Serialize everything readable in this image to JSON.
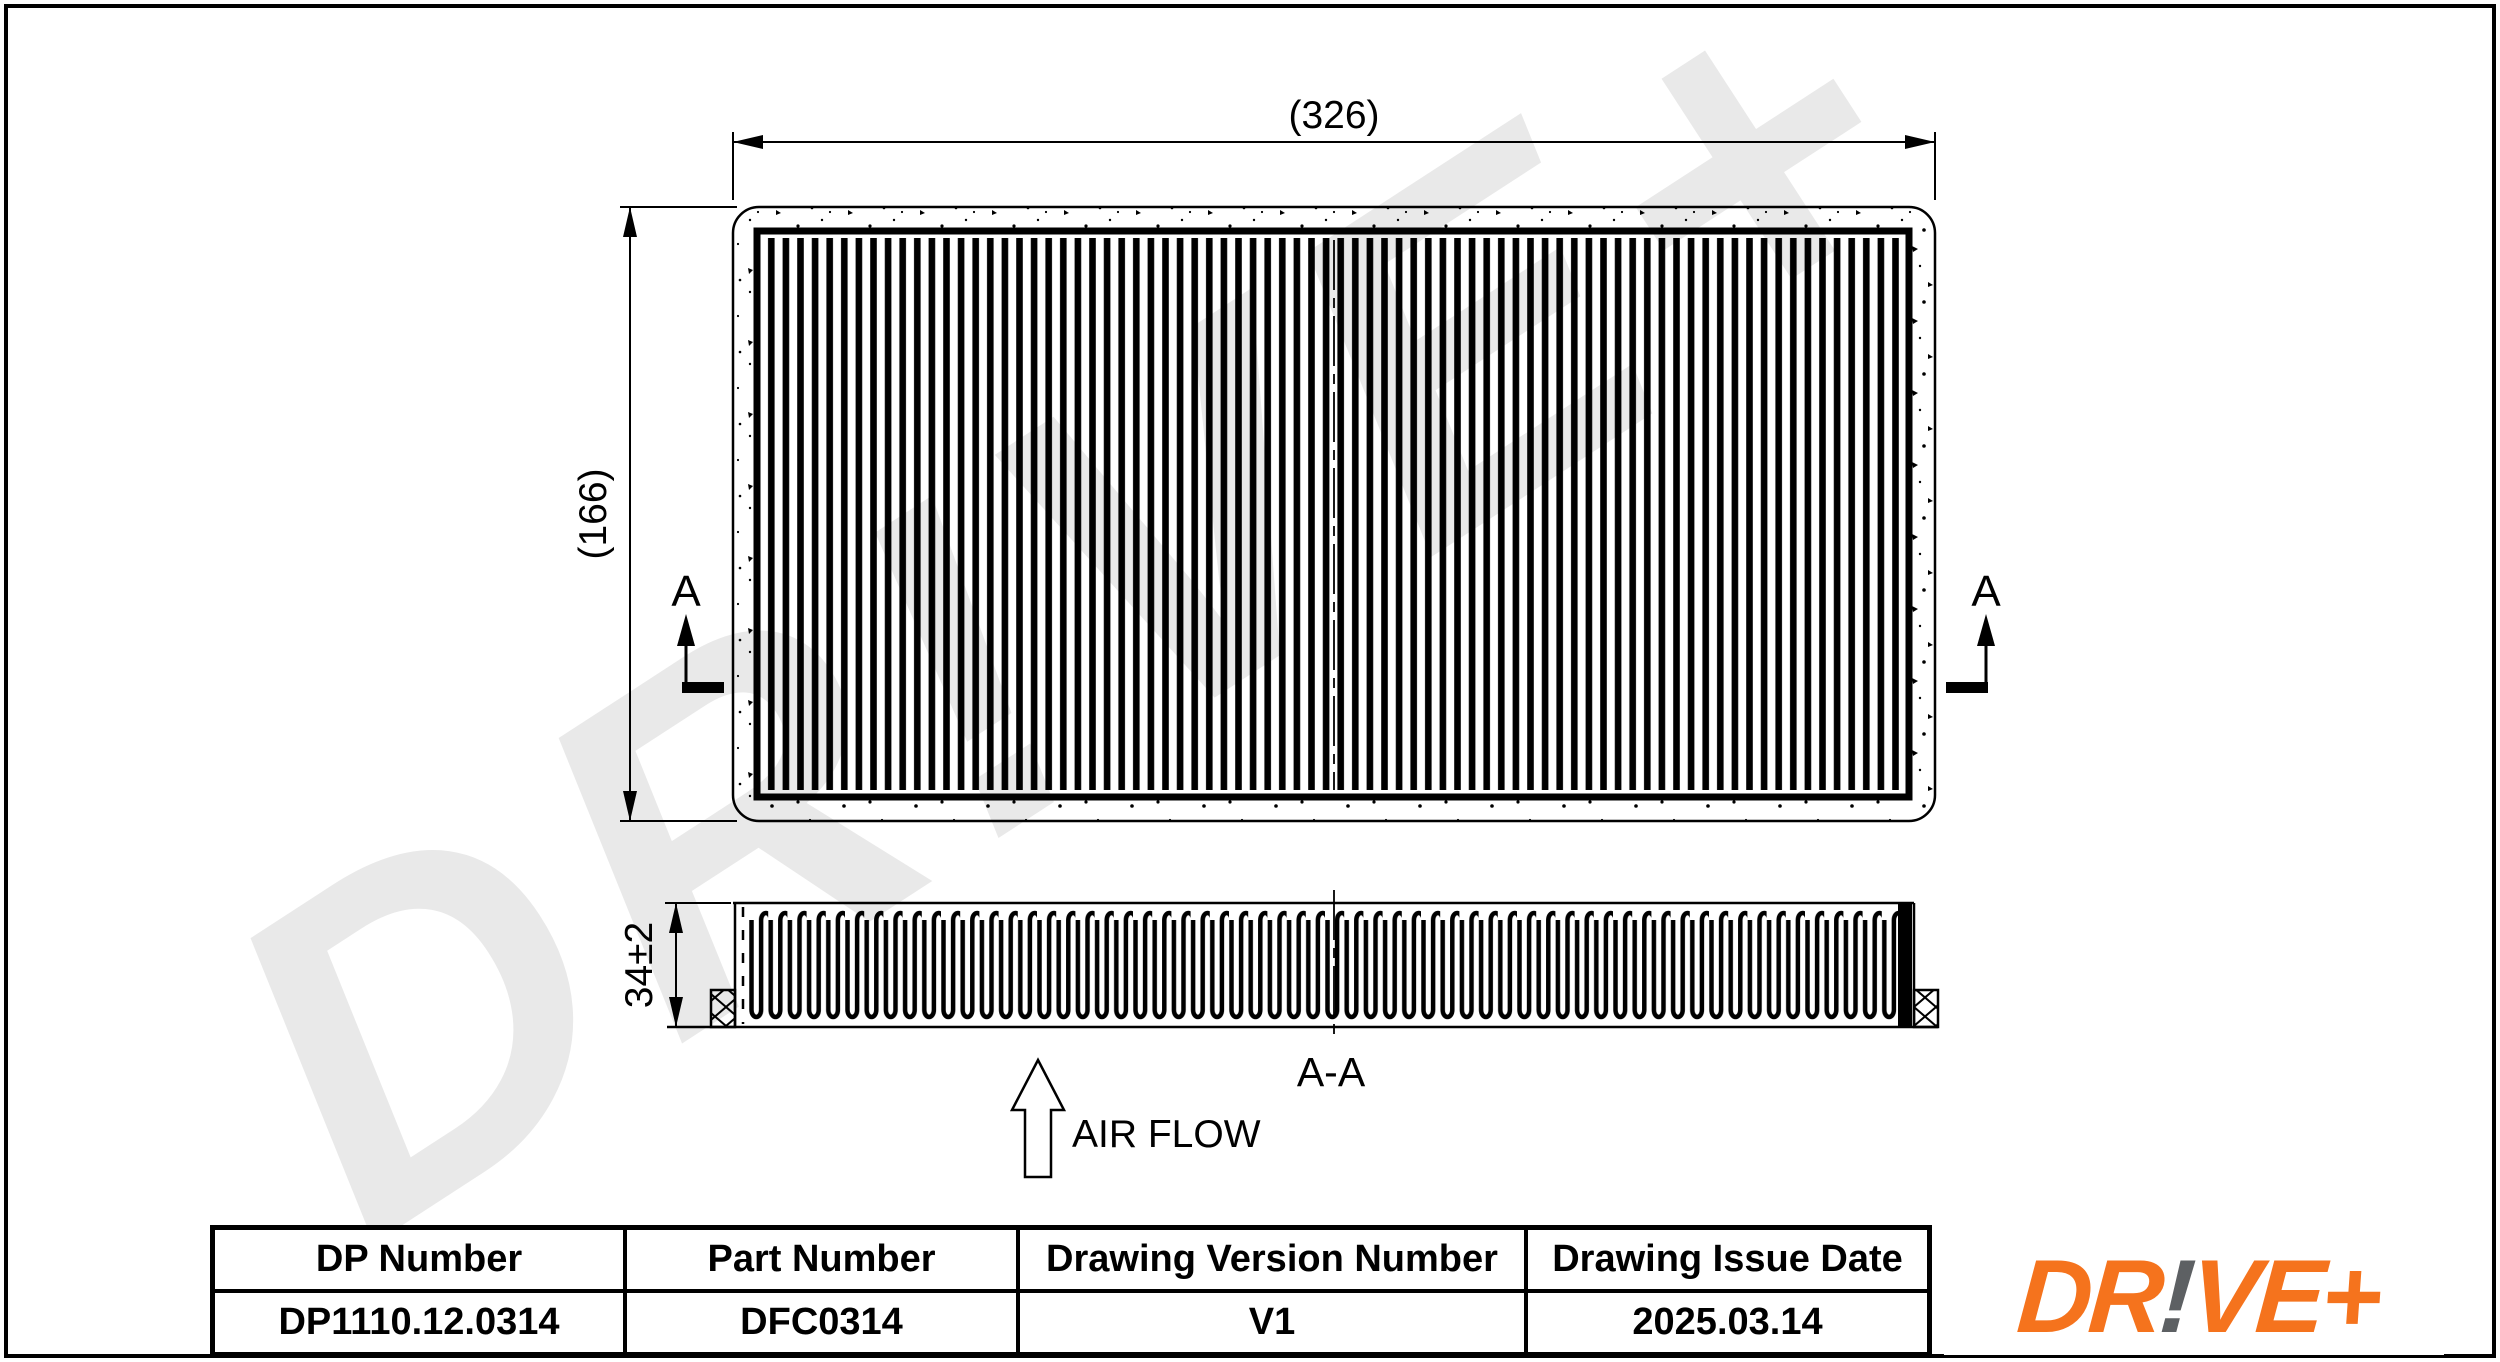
{
  "drawing": {
    "dimensions": {
      "width_label": "(326)",
      "height_label": "(166)",
      "thickness_label": "34±2"
    },
    "section": {
      "marker": "A",
      "label": "A-A"
    },
    "airflow_label": "AIR FLOW"
  },
  "table": {
    "columns": [
      {
        "header": "DP Number",
        "value": "DP1110.12.0314"
      },
      {
        "header": "Part Number",
        "value": "DFC0314"
      },
      {
        "header": "Drawing Version Number",
        "value": "V1"
      },
      {
        "header": "Drawing Issue Date",
        "value": "2025.03.14"
      }
    ]
  },
  "logo": {
    "part1": "DR",
    "bang": "!",
    "part2": "VE+",
    "orange": "#F5731D",
    "gray": "#5D6063"
  },
  "watermark": {
    "text": "DR!VE+",
    "color": "#e9e9e9"
  }
}
